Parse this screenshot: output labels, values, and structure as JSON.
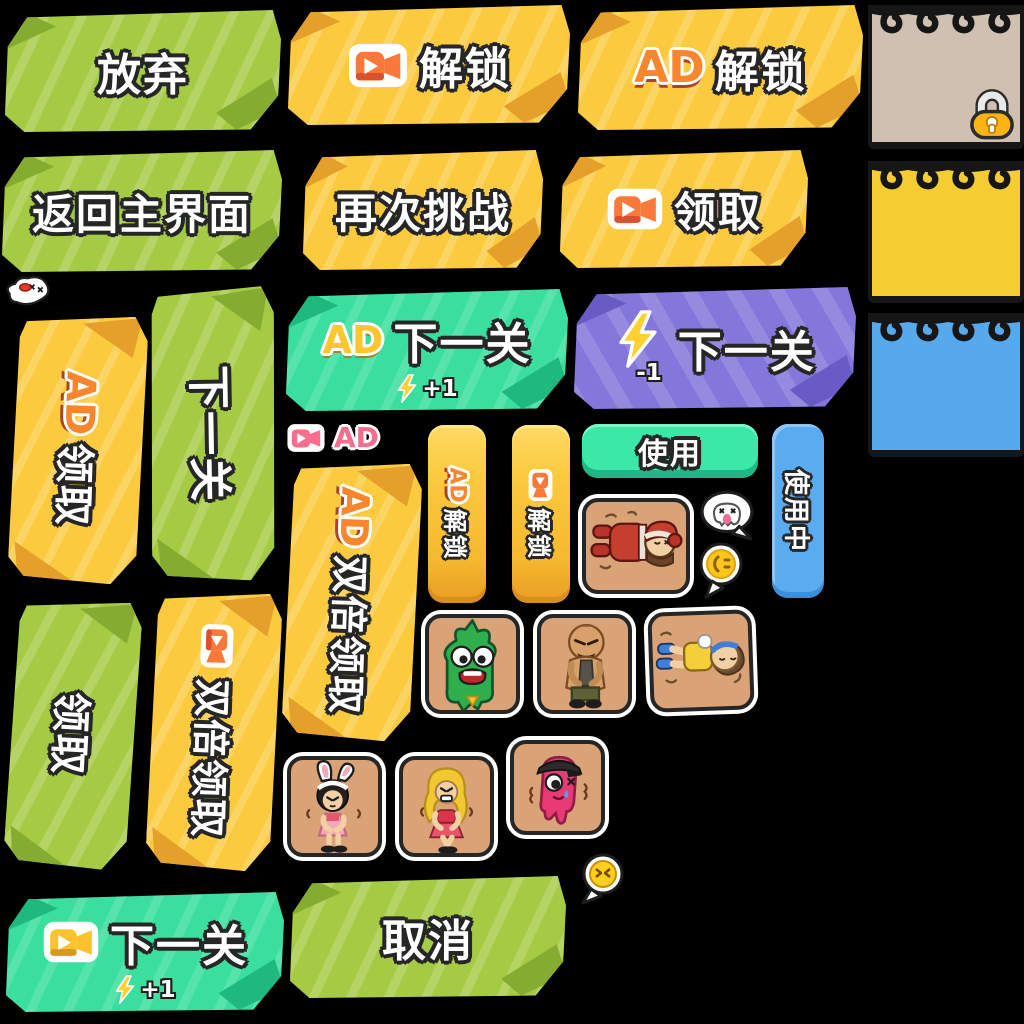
{
  "sheet": {
    "buttons": {
      "give_up": {
        "label": "放弃"
      },
      "video_unlock": {
        "label": "解锁"
      },
      "ad_unlock": {
        "prefix": "AD",
        "label": "解锁"
      },
      "back_to_main": {
        "label": "返回主界面"
      },
      "retry": {
        "label": "再次挑战"
      },
      "video_claim": {
        "label": "领取"
      },
      "ad_claim_strip": {
        "prefix": "AD",
        "label": "领取"
      },
      "next_level_strip": {
        "label": "下一关"
      },
      "ad_next_level": {
        "prefix": "AD",
        "label": "下一关",
        "cost": "+1"
      },
      "energy_next_level": {
        "label": "下一关",
        "cost": "-1"
      },
      "ad_video_badge": {
        "label": "AD"
      },
      "ad_double_claim_strip": {
        "prefix": "AD",
        "label": "双倍领取"
      },
      "claim_strip": {
        "label": "领取"
      },
      "double_claim_strip": {
        "label": "双倍领取"
      },
      "ad_unlock_pill": {
        "prefix": "AD",
        "label": "解锁"
      },
      "video_unlock_pill": {
        "label": "解锁"
      },
      "use": {
        "label": "使用"
      },
      "in_use": {
        "label": "使用中"
      },
      "video_next_level": {
        "label": "下一关",
        "cost": "+1"
      },
      "cancel": {
        "label": "取消"
      }
    },
    "icons": {
      "video_camera": "video-camera-icon",
      "lightning": "lightning-bolt-icon",
      "padlock": "padlock-icon",
      "ghost": "ghost-icon",
      "ghost_bubble": "ghost-speech-bubble-icon",
      "coin_bubble": "coin-speech-bubble-icon",
      "emoji_bubble": "squint-emoji-speech-bubble-icon"
    },
    "characters": [
      "santa",
      "green-monster",
      "bald-man",
      "sleeping-girl",
      "bunny-girl",
      "blonde-girl",
      "pink-monster"
    ],
    "colors": {
      "green": "#a5ca43",
      "green_dark": "#86ab31",
      "yellow": "#fbca3e",
      "yellow_dark": "#e4a02a",
      "teal": "#3adf9e",
      "teal_dark": "#1fb87e",
      "purple": "#8476db",
      "purple_dark": "#695bc6",
      "blue": "#58a8ee",
      "pink": "#fb6d8d",
      "card_brown": "#d9a377",
      "notepad_tan": "#cfc0b1",
      "notepad_yellow": "#f5cd32",
      "notepad_blue": "#57a9ee"
    }
  }
}
